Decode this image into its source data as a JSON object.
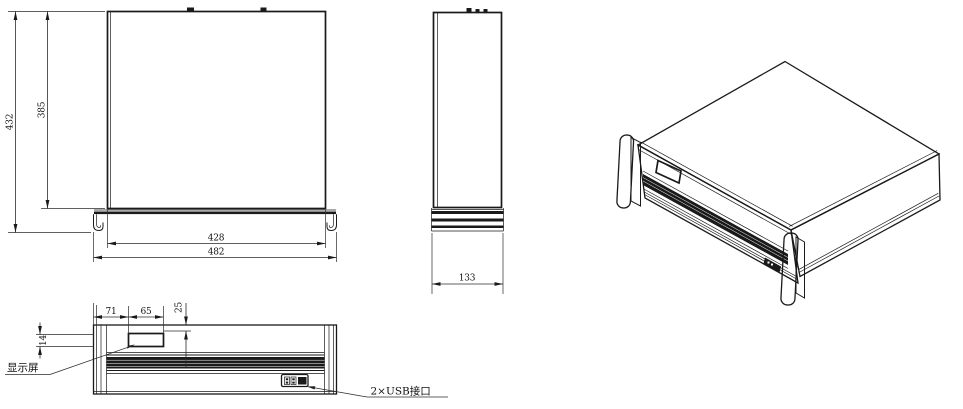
{
  "drawing": {
    "background_color": "#ffffff",
    "line_color": "#1a1a1a",
    "views": {
      "top": {
        "dims": {
          "overall_depth": "432",
          "body_depth": "385",
          "body_width": "428",
          "overall_width": "482"
        }
      },
      "side": {
        "dims": {
          "depth": "133"
        }
      },
      "front": {
        "dims": {
          "display_offset_left": "71",
          "display_width": "65",
          "display_height": "14",
          "display_offset_top": "25"
        },
        "callouts": {
          "display": "显示屏",
          "usb": "2×USB接口"
        }
      }
    }
  }
}
